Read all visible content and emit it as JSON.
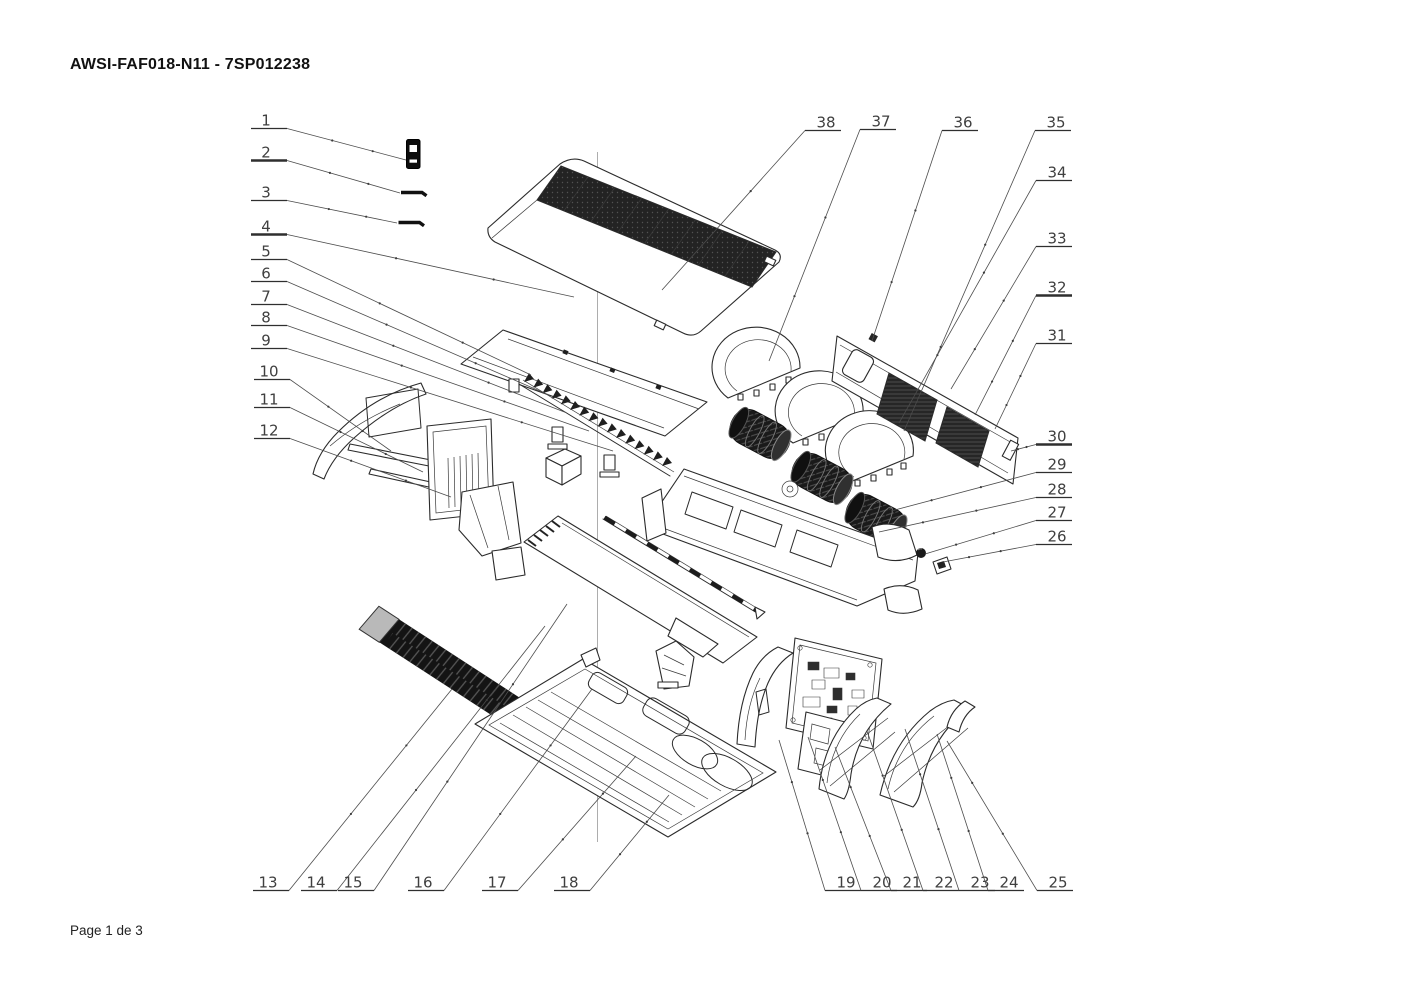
{
  "page": {
    "title": "AWSI-FAF018-N11 - 7SP012238",
    "footer": "Page 1 de 3"
  },
  "diagram": {
    "type": "exploded-parts-view",
    "part_count": 38,
    "callouts": [
      {
        "n": "1",
        "tx": 266,
        "ty": 120,
        "side": "R",
        "lx": 406,
        "ly": 160
      },
      {
        "n": "2",
        "tx": 266,
        "ty": 152,
        "side": "R",
        "lx": 400,
        "ly": 193,
        "hb": true
      },
      {
        "n": "3",
        "tx": 266,
        "ty": 192,
        "side": "R",
        "lx": 397,
        "ly": 223
      },
      {
        "n": "4",
        "tx": 266,
        "ty": 226,
        "side": "R",
        "lx": 574,
        "ly": 297,
        "hb": true
      },
      {
        "n": "5",
        "tx": 266,
        "ty": 251,
        "side": "R",
        "lx": 531,
        "ly": 375
      },
      {
        "n": "6",
        "tx": 266,
        "ty": 273,
        "side": "R",
        "lx": 549,
        "ly": 395
      },
      {
        "n": "7",
        "tx": 266,
        "ty": 296,
        "side": "R",
        "lx": 567,
        "ly": 413
      },
      {
        "n": "8",
        "tx": 266,
        "ty": 317,
        "side": "R",
        "lx": 589,
        "ly": 431
      },
      {
        "n": "9",
        "tx": 266,
        "ty": 340,
        "side": "R",
        "lx": 613,
        "ly": 451
      },
      {
        "n": "10",
        "tx": 269,
        "ty": 371,
        "side": "R",
        "lx": 391,
        "ly": 451
      },
      {
        "n": "11",
        "tx": 269,
        "ty": 399,
        "side": "R",
        "lx": 423,
        "ly": 472
      },
      {
        "n": "12",
        "tx": 269,
        "ty": 430,
        "side": "R",
        "lx": 451,
        "ly": 497
      },
      {
        "n": "13",
        "tx": 268,
        "ty": 882,
        "side": "R",
        "lx": 452,
        "ly": 689
      },
      {
        "n": "14",
        "tx": 316,
        "ty": 882,
        "side": "R",
        "lx": 545,
        "ly": 626
      },
      {
        "n": "15",
        "tx": 353,
        "ty": 882,
        "side": "R",
        "lx": 567,
        "ly": 604
      },
      {
        "n": "16",
        "tx": 423,
        "ty": 882,
        "side": "R",
        "lx": 592,
        "ly": 689
      },
      {
        "n": "17",
        "tx": 497,
        "ty": 882,
        "side": "R",
        "lx": 636,
        "ly": 756
      },
      {
        "n": "18",
        "tx": 569,
        "ty": 882,
        "side": "R",
        "lx": 669,
        "ly": 795
      },
      {
        "n": "19",
        "tx": 846,
        "ty": 882,
        "side": "L",
        "lx": 779,
        "ly": 740
      },
      {
        "n": "20",
        "tx": 882,
        "ty": 882,
        "side": "L",
        "lx": 808,
        "ly": 737
      },
      {
        "n": "21",
        "tx": 912,
        "ty": 882,
        "side": "L",
        "lx": 835,
        "ly": 747
      },
      {
        "n": "22",
        "tx": 944,
        "ty": 882,
        "side": "L",
        "lx": 867,
        "ly": 731
      },
      {
        "n": "23",
        "tx": 980,
        "ty": 882,
        "side": "L",
        "lx": 905,
        "ly": 729
      },
      {
        "n": "24",
        "tx": 1009,
        "ty": 882,
        "side": "L",
        "lx": 937,
        "ly": 734
      },
      {
        "n": "25",
        "tx": 1058,
        "ty": 882,
        "side": "L",
        "lx": 947,
        "ly": 741
      },
      {
        "n": "26",
        "tx": 1057,
        "ty": 536,
        "side": "L",
        "lx": 943,
        "ly": 562
      },
      {
        "n": "27",
        "tx": 1057,
        "ty": 512,
        "side": "L",
        "lx": 925,
        "ly": 554
      },
      {
        "n": "28",
        "tx": 1057,
        "ty": 489,
        "side": "L",
        "lx": 879,
        "ly": 532
      },
      {
        "n": "29",
        "tx": 1057,
        "ty": 464,
        "side": "L",
        "lx": 891,
        "ly": 511
      },
      {
        "n": "30",
        "tx": 1057,
        "ty": 436,
        "side": "L",
        "lx": 1011,
        "ly": 451,
        "hb": true
      },
      {
        "n": "31",
        "tx": 1057,
        "ty": 335,
        "side": "L",
        "lx": 995,
        "ly": 429
      },
      {
        "n": "32",
        "tx": 1057,
        "ty": 287,
        "side": "L",
        "lx": 975,
        "ly": 415,
        "hb": true
      },
      {
        "n": "33",
        "tx": 1057,
        "ty": 238,
        "side": "L",
        "lx": 951,
        "ly": 389
      },
      {
        "n": "34",
        "tx": 1057,
        "ty": 172,
        "side": "L",
        "lx": 899,
        "ly": 423
      },
      {
        "n": "35",
        "tx": 1056,
        "ty": 122,
        "side": "L",
        "lx": 904,
        "ly": 431
      },
      {
        "n": "36",
        "tx": 963,
        "ty": 122,
        "side": "L",
        "lx": 872,
        "ly": 341
      },
      {
        "n": "37",
        "tx": 881,
        "ty": 121,
        "side": "L",
        "lx": 769,
        "ly": 361
      },
      {
        "n": "38",
        "tx": 826,
        "ty": 122,
        "side": "L",
        "lx": 662,
        "ly": 290
      }
    ]
  }
}
